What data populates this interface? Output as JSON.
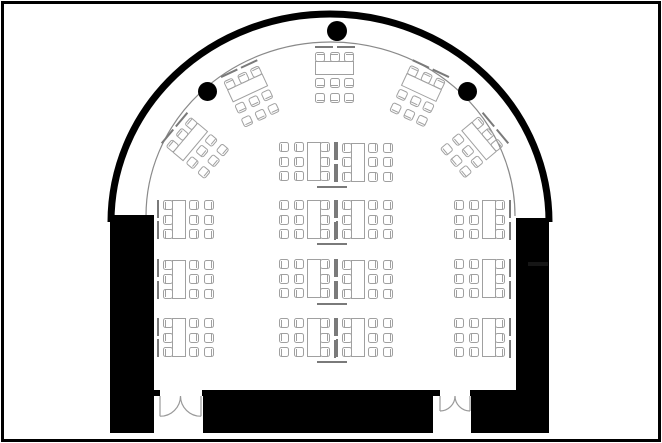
{
  "scene": {
    "type": "floor-plan",
    "summary": {
      "workstations": 19,
      "tables": 19,
      "seats_per_station": 9,
      "total_seats": 171,
      "structural_columns": 3,
      "double_doors": 2,
      "center_station_pairs": 4,
      "side_station_rows": 3,
      "arched_stations": 5
    }
  },
  "colors": {
    "bg": "#ffffff",
    "frame": "#000000",
    "wall": "#000000",
    "dot": "#000000",
    "arc_outer": "#000000",
    "arc_inner": "#8a8a8a",
    "furn": "#a0a0a0",
    "div": "#7a7a7a",
    "door": "#999999",
    "dash": "#161616"
  },
  "structure": {
    "arch_outer": {
      "x1": 111,
      "x2": 549,
      "y": 222,
      "rx": 219,
      "ry": 208,
      "stroke_width": 7
    },
    "arch_inner": {
      "x1": 146,
      "x2": 515,
      "y": 216,
      "rx": 184.5,
      "ry": 174,
      "stroke_width": 1.2
    },
    "walls": [
      {
        "name": "left-wall",
        "x": 110,
        "y": 215,
        "w": 44,
        "h": 218
      },
      {
        "name": "right-wall",
        "x": 516,
        "y": 218,
        "w": 33,
        "h": 215
      },
      {
        "name": "stage-block",
        "x": 203,
        "y": 390,
        "w": 230,
        "h": 43
      },
      {
        "name": "bottom-right-wall",
        "x": 471,
        "y": 390,
        "w": 78,
        "h": 43
      },
      {
        "name": "door-jamb",
        "x": 150,
        "y": 390,
        "w": 10,
        "h": 6
      },
      {
        "name": "door-jamb",
        "x": 202,
        "y": 390,
        "w": 8,
        "h": 6
      },
      {
        "name": "door-jamb",
        "x": 432,
        "y": 390,
        "w": 8,
        "h": 6
      },
      {
        "name": "door-jamb",
        "x": 470,
        "y": 390,
        "w": 8,
        "h": 6
      }
    ],
    "wall_dash": {
      "x": 528,
      "y": 262,
      "w": 20,
      "h": 4
    },
    "columns": [
      {
        "x": 337,
        "y": 31,
        "r": 10
      },
      {
        "x": 207,
        "y": 91,
        "r": 9.5
      },
      {
        "x": 467,
        "y": 91,
        "r": 9.5
      }
    ],
    "doors": [
      {
        "hinge_left": 160,
        "hinge_right": 201,
        "meet_x": 180.5,
        "y": 396,
        "radius": 20.2
      },
      {
        "hinge_left": 440,
        "hinge_right": 470,
        "meet_x": 455,
        "y": 396,
        "radius": 15
      }
    ]
  },
  "furniture": {
    "station_size": {
      "w": 58,
      "h": 40
    },
    "chair_rows": [
      0.5,
      15,
      29.5
    ],
    "tucked_col_x": 5.5,
    "loose_cols_x": [
      31.5,
      47
    ],
    "divider_segments_y": [
      0,
      21.5
    ],
    "stations": [
      {
        "cx": 196,
        "cy": 146,
        "rot": 40
      },
      {
        "cx": 251,
        "cy": 94,
        "rot": 65
      },
      {
        "cx": 335,
        "cy": 75,
        "rot": 90
      },
      {
        "cx": 419,
        "cy": 94,
        "rot": 115
      },
      {
        "cx": 474,
        "cy": 146,
        "rot": 140
      },
      {
        "cx": 307,
        "cy": 162,
        "rot": 180
      },
      {
        "cx": 365,
        "cy": 162,
        "rot": 0
      },
      {
        "cx": 186,
        "cy": 219.5,
        "rot": 0
      },
      {
        "cx": 307,
        "cy": 219.5,
        "rot": 180
      },
      {
        "cx": 365,
        "cy": 219.5,
        "rot": 0
      },
      {
        "cx": 482,
        "cy": 219.5,
        "rot": 180
      },
      {
        "cx": 186,
        "cy": 279,
        "rot": 0
      },
      {
        "cx": 307,
        "cy": 279,
        "rot": 180
      },
      {
        "cx": 365,
        "cy": 279,
        "rot": 0
      },
      {
        "cx": 482,
        "cy": 279,
        "rot": 180
      },
      {
        "cx": 186,
        "cy": 337.5,
        "rot": 0
      },
      {
        "cx": 307,
        "cy": 337.5,
        "rot": 180
      },
      {
        "cx": 365,
        "cy": 337.5,
        "rot": 0
      },
      {
        "cx": 482,
        "cy": 337.5,
        "rot": 180
      }
    ],
    "pair_lines": [
      {
        "x": 317,
        "y": 185.5
      },
      {
        "x": 317,
        "y": 243
      },
      {
        "x": 317,
        "y": 302.5
      },
      {
        "x": 317,
        "y": 361
      }
    ]
  }
}
